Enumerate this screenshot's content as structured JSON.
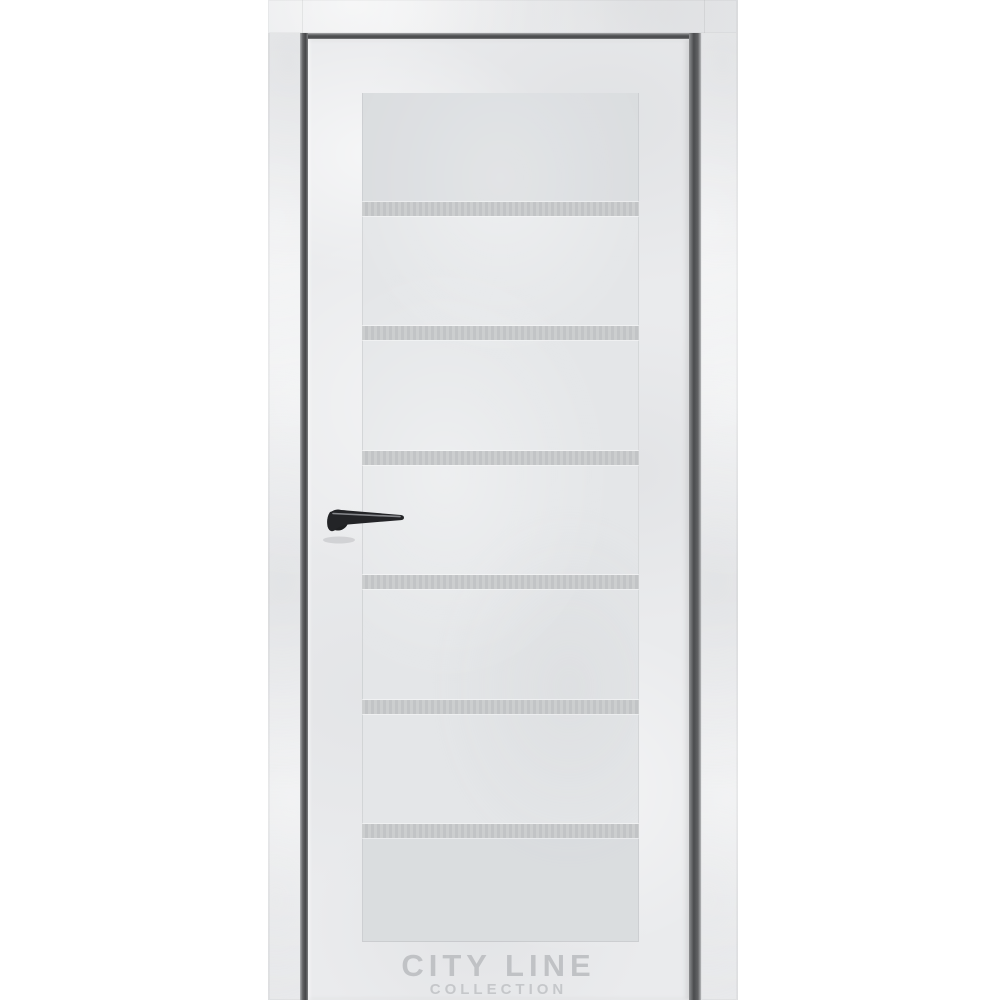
{
  "watermark": {
    "title": "CITY LINE",
    "subtitle": "COLLECTION"
  },
  "door": {
    "glass_insert_count": 6,
    "colors": {
      "background": "#ffffff",
      "door_finish": "#eaebed",
      "panel": "#e4e6e8",
      "glass_insert": "#c6c8ca",
      "reveal_gap": "#4b4c4e",
      "handle_body": "#1f2022",
      "handle_highlight": "#97999d",
      "watermark_text": "#c0c2c5"
    }
  }
}
